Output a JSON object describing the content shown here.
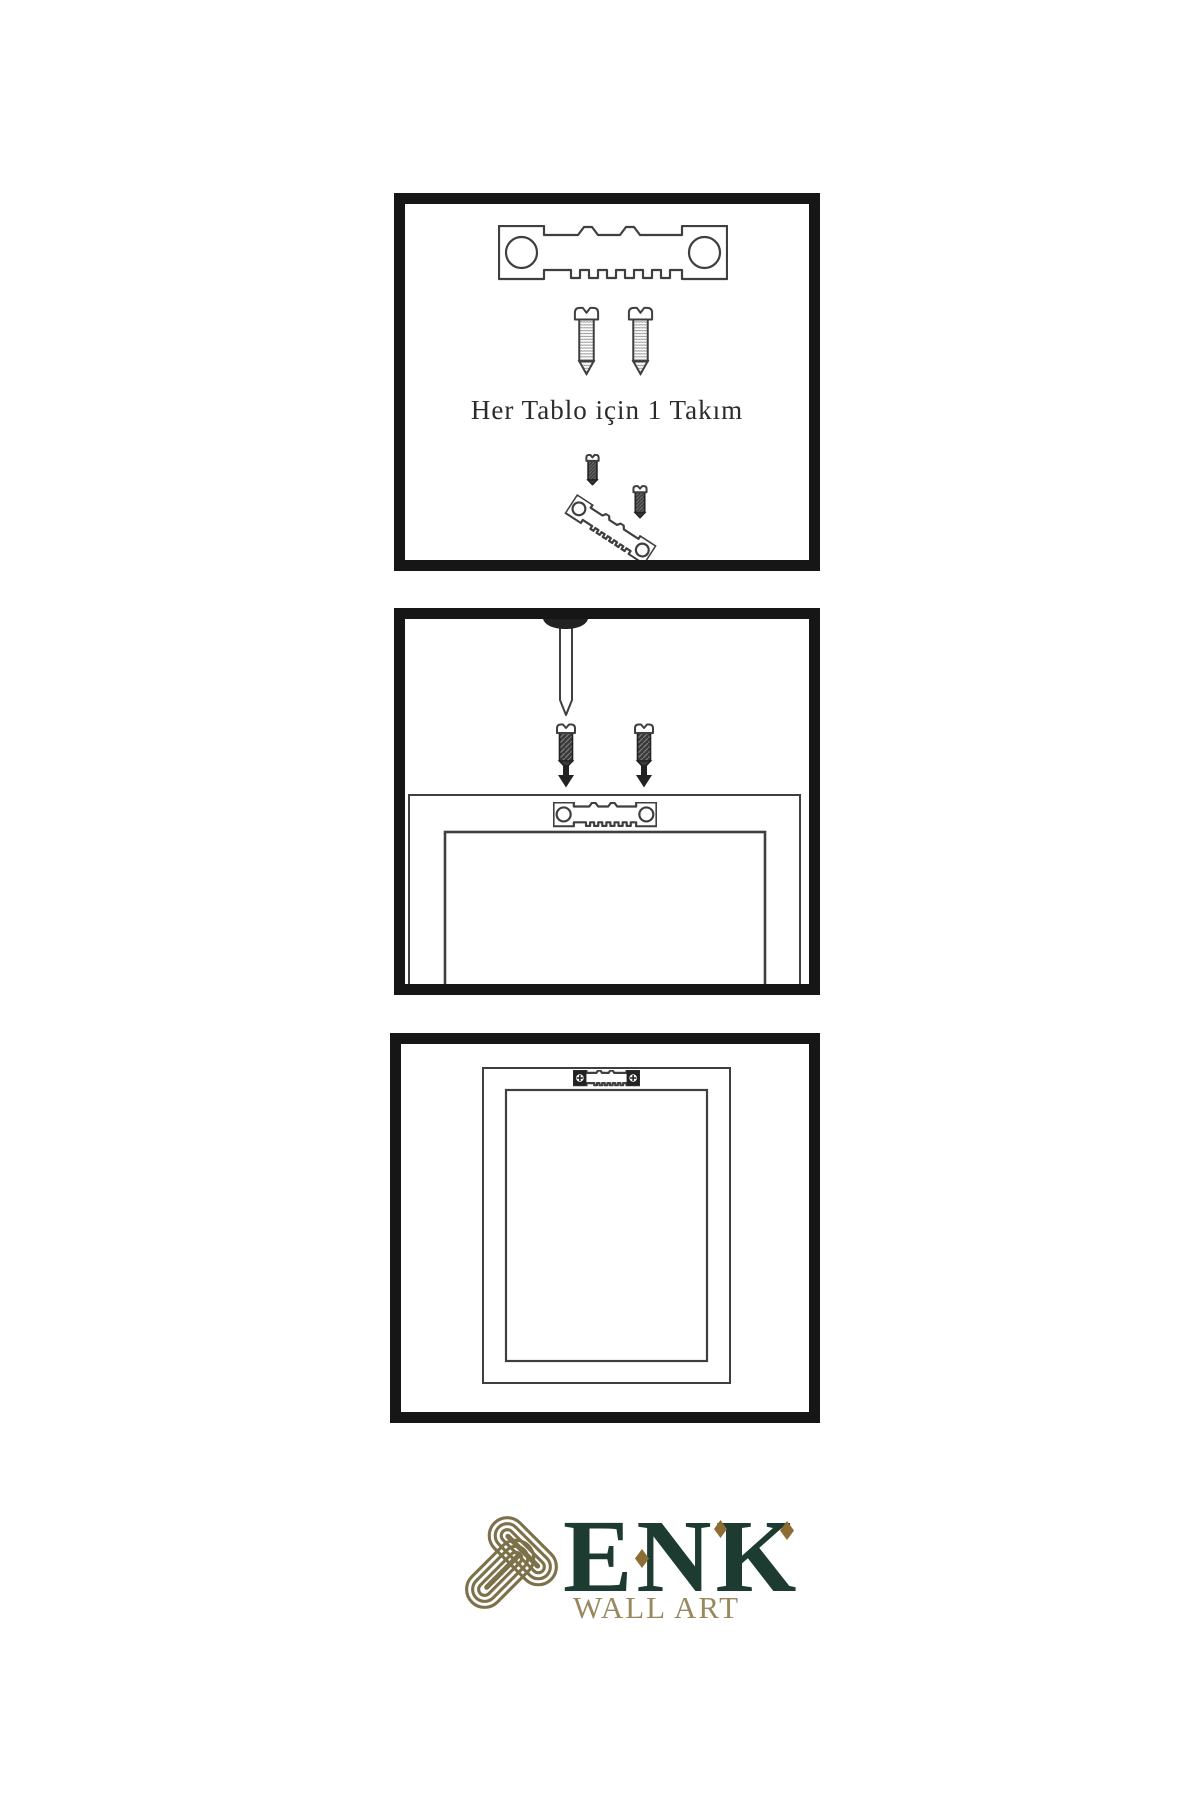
{
  "colors": {
    "background": "#ffffff",
    "panel_border": "#161616",
    "line": "#3f3f3f",
    "ink": "#222222",
    "dark_metal": "#3a3a3a",
    "text": "#2b2b2b",
    "brand_green": "#1d3b30",
    "brand_gold": "#8c6d33",
    "brand_olive": "#7c7149",
    "brand_tan": "#99895f"
  },
  "steps": {
    "kit": {
      "caption": "Her Tablo için 1 Takım",
      "icons": [
        "sawtooth-hanger",
        "screw",
        "screw",
        "screw-into-tilted-hanger"
      ]
    },
    "mount": {
      "icons": [
        "nail",
        "screw",
        "screw",
        "arrow-down",
        "arrow-down",
        "picture-frame-back-with-hanger"
      ]
    },
    "hang": {
      "icons": [
        "picture-frame-back-with-hanger-installed"
      ]
    }
  },
  "logo": {
    "brand": "ENK",
    "subtitle": "WALL ART",
    "icons": {
      "knot": "interlocked-loops-knot",
      "accent": "◆"
    }
  }
}
